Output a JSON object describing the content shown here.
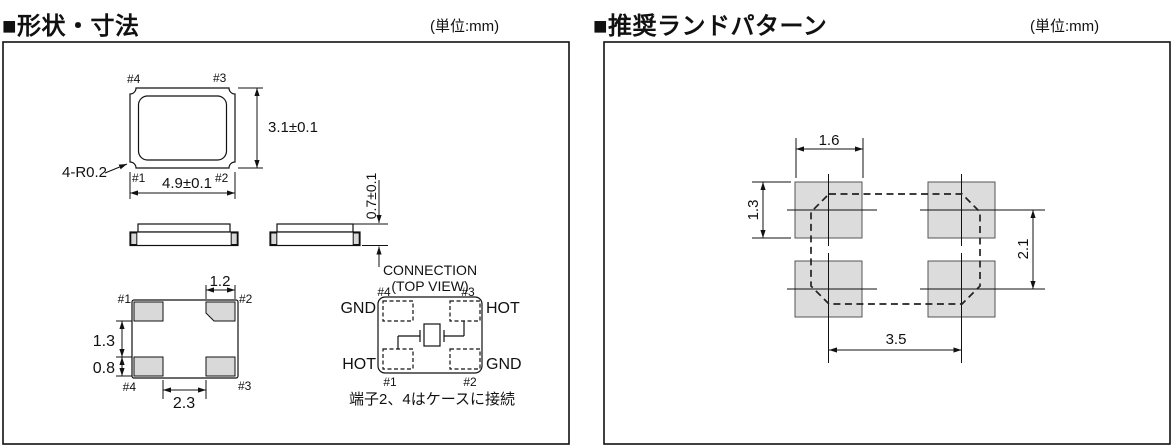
{
  "header": {
    "left": {
      "title": "■形状・寸法",
      "unit": "(単位:mm)"
    },
    "right": {
      "title": "■推奨ランドパターン",
      "unit": "(単位:mm)"
    }
  },
  "package": {
    "top_view": {
      "pin_top_left": "#4",
      "pin_top_right": "#3",
      "pin_bottom_left": "#1",
      "pin_bottom_right": "#2",
      "body_width": "4.9±0.1",
      "body_height": "3.1±0.1",
      "corner_note": "4-R0.2"
    },
    "side_view": {
      "thickness": "0.7±0.1"
    },
    "bottom_view": {
      "pin_top_left": "#1",
      "pin_top_right": "#2",
      "pin_bottom_left": "#4",
      "pin_bottom_right": "#3",
      "pad_width": "1.2",
      "pad_gap": "1.3",
      "pad_height": "0.8",
      "pad_span": "2.3"
    }
  },
  "connection": {
    "title": "CONNECTION",
    "subtitle": "(TOP VIEW)",
    "pin_top_left": "#4",
    "pin_top_right": "#3",
    "pin_bottom_left": "#1",
    "pin_bottom_right": "#2",
    "terminal_top_left": "GND",
    "terminal_top_right": "HOT",
    "terminal_bottom_left": "HOT",
    "terminal_bottom_right": "GND",
    "note": "端子2、4はケースに接続"
  },
  "land_pattern": {
    "pad_width": "1.6",
    "pad_height": "1.3",
    "vertical_pitch": "2.1",
    "horizontal_pitch": "3.5"
  },
  "colors": {
    "package_pad_fill": "#d9d9d9",
    "land_pad_fill": "#dcdcdc",
    "line": "#111111",
    "background": "#ffffff"
  }
}
